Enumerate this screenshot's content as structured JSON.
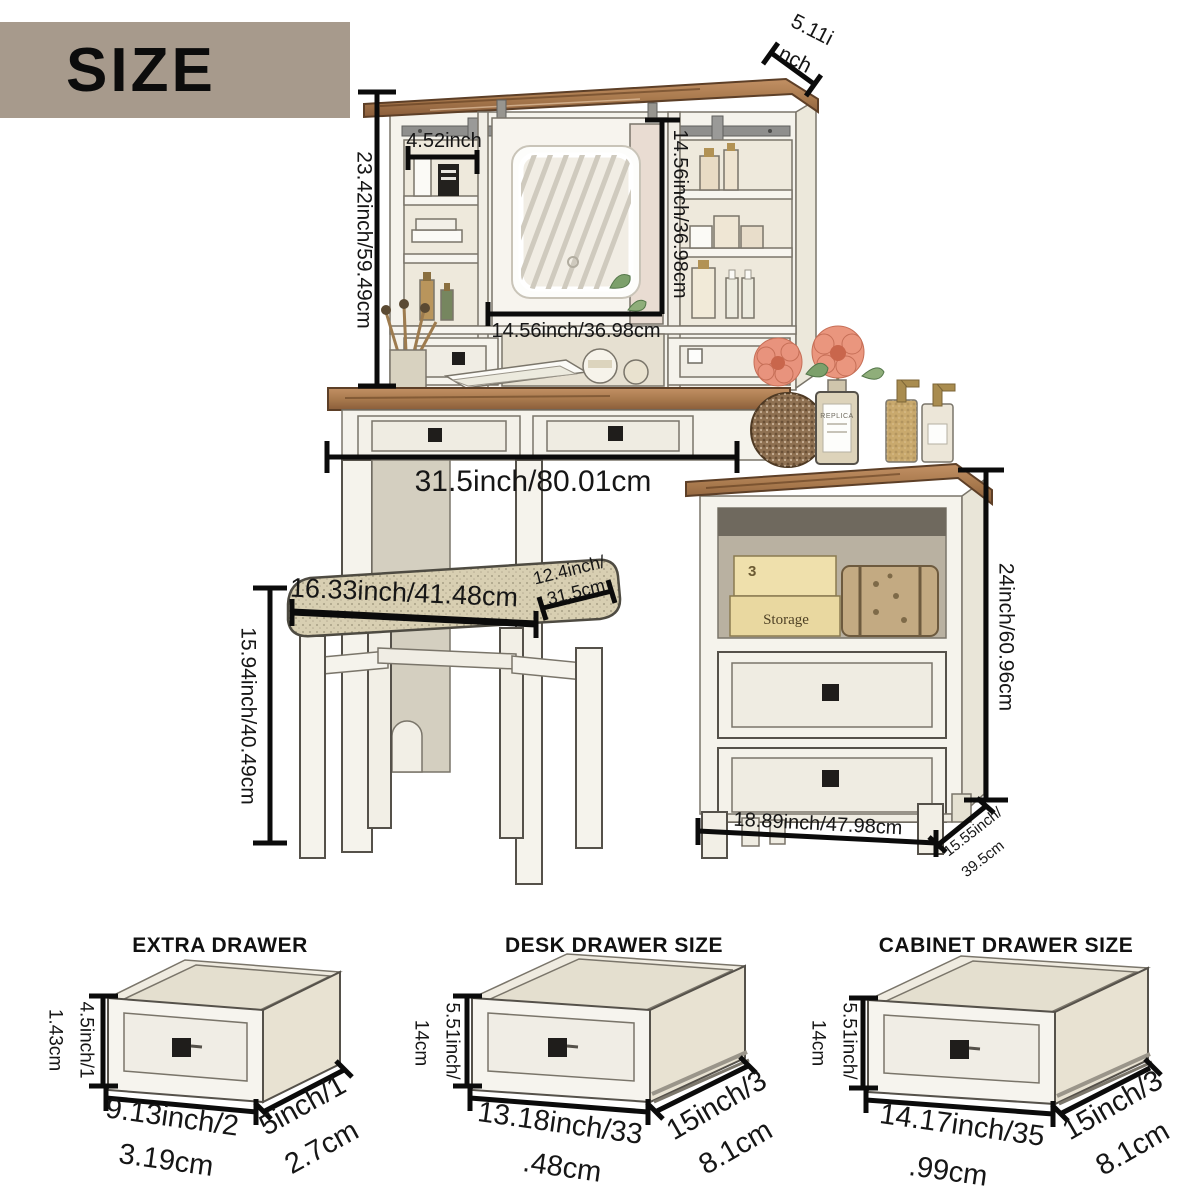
{
  "page_title": "SIZE",
  "colors": {
    "banner": "#a79a8c",
    "wood": "#a97a4e",
    "furniture_body": "#f5f3ec",
    "cushion": "#d8cfb2",
    "knob": "#1f1d1b",
    "dimension_line": "#0b0b0b"
  },
  "main_diagram": {
    "hutch_top_depth": {
      "line1": "5.11i",
      "line2": "nch"
    },
    "left_shelf_width": "4.52inch",
    "hutch_height": "23.42inch/59.49cm",
    "mirror_height": "14.56inch/36.98cm",
    "mirror_width": "14.56inch/36.98cm",
    "desk_width": "31.5inch/80.01cm",
    "stool_width": "16.33inch/41.48cm",
    "stool_depth": {
      "line1": "12.4inch/",
      "line2": "31.5cm"
    },
    "stool_height": "15.94inch/40.49cm",
    "cabinet_height": "24inch/60.96cm",
    "cabinet_width": "18.89inch/47.98cm",
    "cabinet_depth": {
      "line1": "15.55inch/",
      "line2": "39.5cm"
    },
    "decor": {
      "storage_box_number": "3",
      "storage_box_label": "Storage",
      "perfume_label": "REPLICA"
    }
  },
  "drawer_sections": [
    {
      "title": "EXTRA DRAWER",
      "height": {
        "line1": "4.5inch/1",
        "line2": "1.43cm"
      },
      "width": {
        "line1": "9.13inch/2",
        "line2": "3.19cm"
      },
      "depth": {
        "line1": "5inch/1",
        "line2": "2.7cm"
      }
    },
    {
      "title": "DESK DRAWER SIZE",
      "height": {
        "line1": "5.51inch/",
        "line2": "14cm"
      },
      "width": {
        "line1": "13.18inch/33",
        "line2": ".48cm"
      },
      "depth": {
        "line1": "15inch/3",
        "line2": "8.1cm"
      }
    },
    {
      "title": "CABINET DRAWER SIZE",
      "height": {
        "line1": "5.51inch/",
        "line2": "14cm"
      },
      "width": {
        "line1": "14.17inch/35",
        "line2": ".99cm"
      },
      "depth": {
        "line1": "15inch/3",
        "line2": "8.1cm"
      }
    }
  ]
}
